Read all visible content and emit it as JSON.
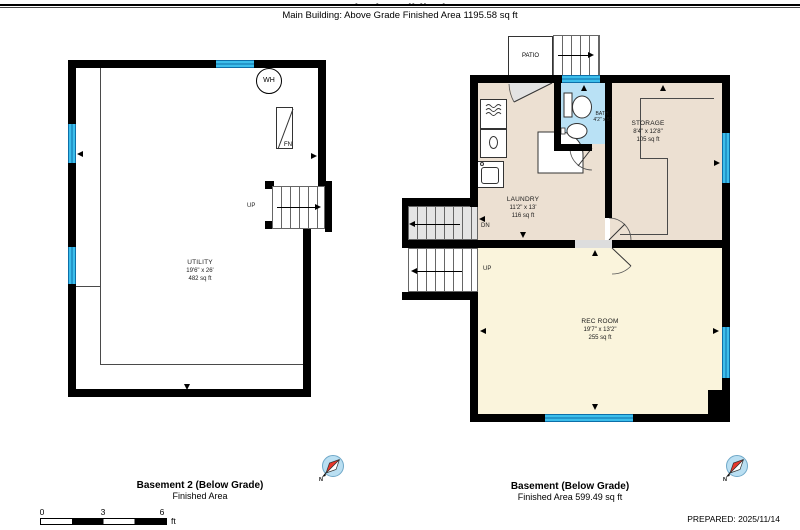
{
  "header": {
    "clipped_title": "(Main Building)",
    "subtitle": "Main Building: Above Grade Finished Area 1195.58 sq ft"
  },
  "basement2": {
    "rooms": {
      "utility": {
        "name": "UTILITY",
        "dims": "19'6\" x 26'",
        "area": "482 sq ft"
      }
    },
    "fixtures": {
      "water_heater": "WH",
      "furnace": "FN"
    },
    "stairs": {
      "up": "UP"
    },
    "caption": {
      "title": "Basement 2 (Below Grade)",
      "subtitle": "Finished Area"
    }
  },
  "basement": {
    "rooms": {
      "laundry": {
        "name": "LAUNDRY",
        "dims": "11'2\" x 13'",
        "area": "116 sq ft"
      },
      "storage": {
        "name": "STORAGE",
        "dims": "8'4\" x 12'8\"",
        "area": "105 sq ft"
      },
      "bath": {
        "name": "BATH",
        "dims": "4'2\" x 5'"
      },
      "rec_room": {
        "name": "REC ROOM",
        "dims": "19'7\" x 13'2\"",
        "area": "255 sq ft"
      }
    },
    "patio_label": "PATIO",
    "stairs": {
      "dn": "DN",
      "up": "UP"
    },
    "caption": {
      "title": "Basement (Below Grade)",
      "subtitle": "Finished Area 599.49 sq ft"
    }
  },
  "scale_bar": {
    "ticks": [
      "0",
      "3",
      "6"
    ],
    "unit": "ft"
  },
  "compass": {
    "north_label": "N"
  },
  "footer": {
    "prepared": "PREPARED: 2025/11/14"
  },
  "colors": {
    "wall": "#000000",
    "window": "#3cbeeb",
    "bath_floor": "#b9e1f5",
    "unfinished_floor": "#ece0d2",
    "finished_floor": "#faf4dc",
    "compass_needle": "#e8362a"
  }
}
